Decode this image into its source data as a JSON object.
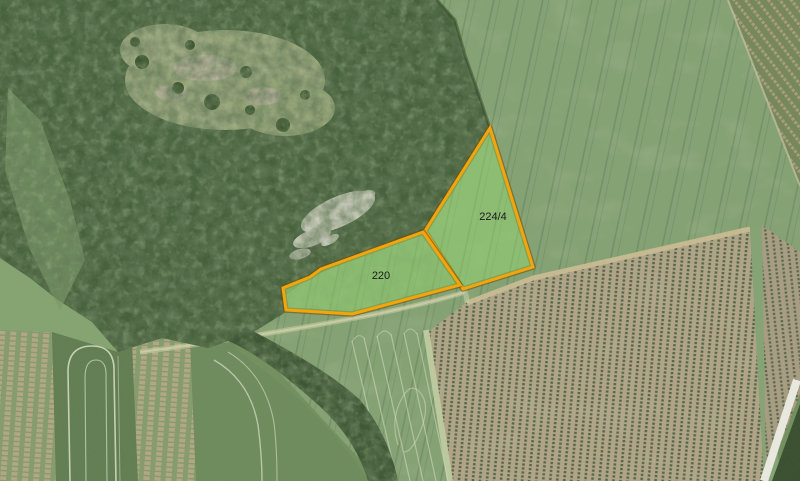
{
  "map": {
    "type": "aerial-orthophoto-with-cadastral-parcels",
    "highlight": {
      "outline_color": "#f2a50d",
      "outline_shadow_color": "#6f4a08",
      "fill_color": "rgba(151,226,112,0.42)",
      "label_color": "#1b1b1b"
    },
    "parcels": [
      {
        "label": "224/4",
        "points": "490,128 533,267 463,289 425,231",
        "label_x": "493",
        "label_y": "220"
      },
      {
        "label": "220",
        "points": "423,232 460,285 352,314 286,310 283,288 310,277 321,269",
        "label_x": "381",
        "label_y": "279"
      }
    ]
  }
}
